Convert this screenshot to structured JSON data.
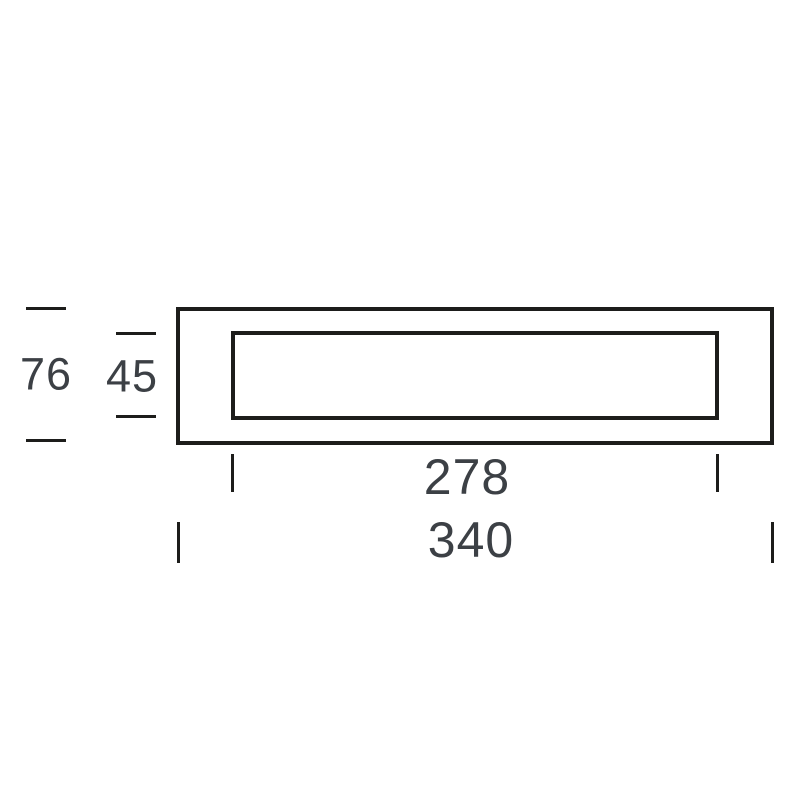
{
  "diagram": {
    "kind": "technical-dimension-drawing",
    "subject": "rectangular frame front elevation with inner opening",
    "labels": {
      "overall_height": "76",
      "inner_height": "45",
      "inner_width": "278",
      "overall_width": "340"
    },
    "colors": {
      "line": "#1d1d1b",
      "text": "#3c4045",
      "background": "#ffffff"
    }
  }
}
